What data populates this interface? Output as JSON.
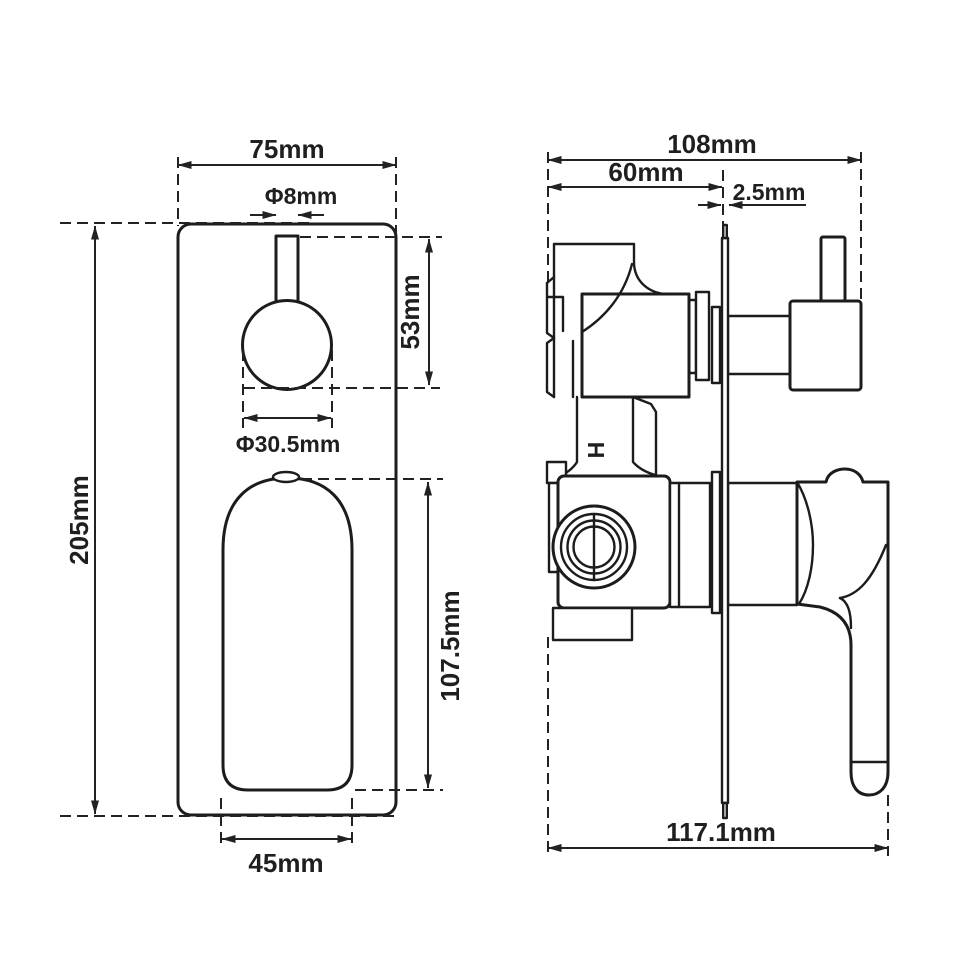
{
  "meta": {
    "background_color": "#ffffff",
    "line_color": "#1c1c1c",
    "text_color": "#1f1f1f",
    "drawing_type": "shower mixer valve dimension drawing"
  },
  "front_view": {
    "name": "front-view",
    "dimensions": {
      "plate_width": "75mm",
      "stem_diameter": "Φ8mm",
      "stem_to_knob": "53mm",
      "knob_diameter": "Φ30.5mm",
      "plate_height": "205mm",
      "handle_height": "107.5mm",
      "handle_width": "45mm"
    }
  },
  "side_view": {
    "name": "side-view",
    "dimensions": {
      "total_depth": "108mm",
      "body_depth": "60mm",
      "plate_thickness": "2.5mm",
      "total_width": "117.1mm"
    },
    "hot_water_marker": "H"
  }
}
